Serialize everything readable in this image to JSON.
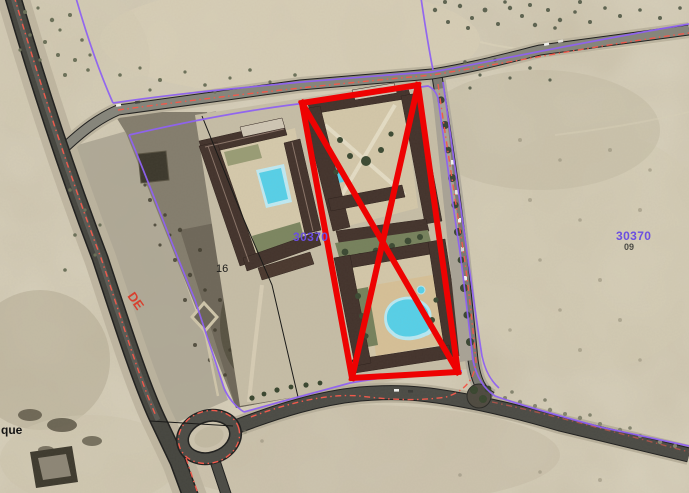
{
  "map": {
    "labels": {
      "parcel_left": "30370",
      "parcel_right": "30370",
      "parcel_right_sub": "09",
      "plot_16": "16",
      "road_de": "DE",
      "street_fragment": "que"
    },
    "colors": {
      "selection_red": "#ee0202",
      "cadastral_purple": "#8f62f2",
      "road_marking_red": "#ef5a4c",
      "parcel_label": "#6b4fe0",
      "terrain": "#cac1aa",
      "pool": "#57d0e8"
    }
  }
}
